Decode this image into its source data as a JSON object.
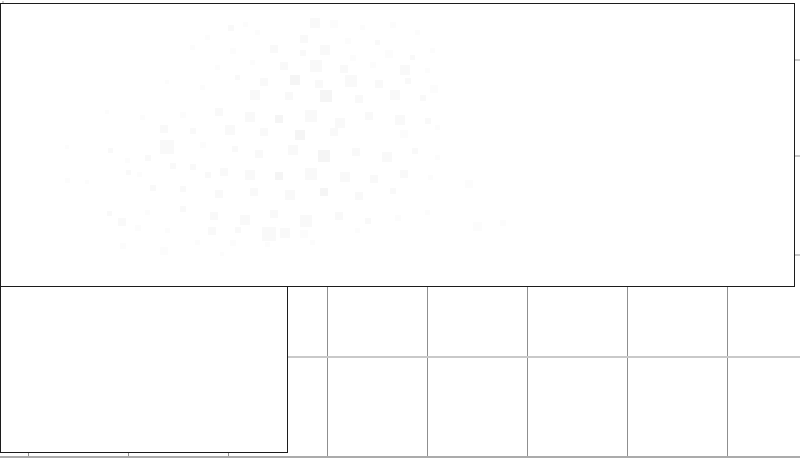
{
  "window": {
    "background_color": "#ffffff",
    "width_px": 800,
    "height_px": 458
  },
  "colors": {
    "panel_frame": "#1c1c1c",
    "panel_fill": "#ffffff",
    "grid_vertical": "#8f8f8f",
    "grid_horizontal": "#c9c9c9",
    "bottom_edge_line": "#ababab",
    "corner_tick": "#cfcfcf"
  },
  "chart_data": {
    "type": "heatmap",
    "title": "",
    "xlabel": "",
    "ylabel": "",
    "description": "Figure with two white framed axes panels over a background grid; top panel contains an extremely faint near-white blocky heatmap speckle cloud; no text labels are visible anywhere.",
    "grid": {
      "spacing_px": 100,
      "vertical_x": [
        28,
        128,
        228,
        327,
        427,
        527,
        627,
        727
      ],
      "horizontal_y": [
        59,
        155,
        254,
        356
      ],
      "bottom_edge_y": 456
    },
    "tick_marks": {
      "right_edge_y": [
        59,
        155,
        254
      ],
      "bottom_edge_x": [
        28,
        128,
        228
      ]
    },
    "point_shades": [
      "#f5f5f5",
      "#f9f9f9",
      "#fcfcfc"
    ],
    "points": [
      [
        243,
        22,
        5,
        2
      ],
      [
        228,
        25,
        6,
        1
      ],
      [
        310,
        18,
        10,
        1
      ],
      [
        330,
        20,
        8,
        2
      ],
      [
        360,
        25,
        5,
        2
      ],
      [
        390,
        22,
        6,
        2
      ],
      [
        205,
        35,
        5,
        2
      ],
      [
        255,
        30,
        5,
        2
      ],
      [
        300,
        35,
        8,
        1
      ],
      [
        345,
        38,
        6,
        2
      ],
      [
        415,
        30,
        5,
        2
      ],
      [
        375,
        40,
        5,
        1
      ],
      [
        190,
        45,
        5,
        2
      ],
      [
        230,
        48,
        6,
        2
      ],
      [
        270,
        45,
        8,
        1
      ],
      [
        300,
        50,
        6,
        1
      ],
      [
        320,
        45,
        10,
        1
      ],
      [
        350,
        55,
        6,
        2
      ],
      [
        385,
        50,
        8,
        2
      ],
      [
        410,
        55,
        5,
        1
      ],
      [
        430,
        48,
        5,
        2
      ],
      [
        250,
        60,
        5,
        2
      ],
      [
        280,
        62,
        8,
        1
      ],
      [
        310,
        60,
        12,
        1
      ],
      [
        340,
        65,
        8,
        1
      ],
      [
        370,
        62,
        6,
        2
      ],
      [
        400,
        65,
        10,
        1
      ],
      [
        425,
        68,
        5,
        2
      ],
      [
        215,
        65,
        5,
        2
      ],
      [
        235,
        75,
        5,
        1
      ],
      [
        260,
        78,
        8,
        1
      ],
      [
        290,
        75,
        10,
        0
      ],
      [
        315,
        80,
        8,
        1
      ],
      [
        345,
        75,
        12,
        1
      ],
      [
        375,
        80,
        8,
        1
      ],
      [
        405,
        78,
        6,
        1
      ],
      [
        430,
        85,
        8,
        2
      ],
      [
        200,
        85,
        5,
        2
      ],
      [
        250,
        90,
        10,
        1
      ],
      [
        285,
        92,
        8,
        1
      ],
      [
        320,
        90,
        12,
        0
      ],
      [
        355,
        95,
        8,
        1
      ],
      [
        390,
        90,
        10,
        1
      ],
      [
        420,
        95,
        6,
        1
      ],
      [
        165,
        80,
        4,
        2
      ],
      [
        105,
        110,
        4,
        2
      ],
      [
        140,
        115,
        5,
        2
      ],
      [
        180,
        112,
        6,
        2
      ],
      [
        215,
        108,
        8,
        1
      ],
      [
        245,
        112,
        10,
        1
      ],
      [
        275,
        115,
        8,
        0
      ],
      [
        305,
        110,
        12,
        1
      ],
      [
        335,
        118,
        10,
        1
      ],
      [
        365,
        112,
        8,
        1
      ],
      [
        395,
        115,
        10,
        1
      ],
      [
        425,
        118,
        6,
        1
      ],
      [
        160,
        125,
        8,
        1
      ],
      [
        190,
        128,
        6,
        1
      ],
      [
        225,
        125,
        10,
        1
      ],
      [
        260,
        128,
        8,
        1
      ],
      [
        295,
        130,
        10,
        0
      ],
      [
        330,
        128,
        8,
        1
      ],
      [
        400,
        130,
        8,
        2
      ],
      [
        435,
        125,
        5,
        2
      ],
      [
        65,
        145,
        4,
        2
      ],
      [
        108,
        148,
        5,
        1
      ],
      [
        160,
        140,
        14,
        1
      ],
      [
        200,
        142,
        6,
        2
      ],
      [
        232,
        146,
        6,
        1
      ],
      [
        255,
        150,
        8,
        1
      ],
      [
        288,
        145,
        10,
        1
      ],
      [
        318,
        150,
        12,
        0
      ],
      [
        352,
        148,
        8,
        1
      ],
      [
        382,
        152,
        10,
        1
      ],
      [
        412,
        148,
        6,
        1
      ],
      [
        435,
        155,
        5,
        2
      ],
      [
        125,
        158,
        5,
        2
      ],
      [
        145,
        155,
        6,
        1
      ],
      [
        126,
        170,
        5,
        1
      ],
      [
        137,
        172,
        5,
        2
      ],
      [
        170,
        163,
        6,
        1
      ],
      [
        190,
        164,
        6,
        1
      ],
      [
        205,
        172,
        6,
        1
      ],
      [
        220,
        168,
        8,
        1
      ],
      [
        245,
        170,
        10,
        1
      ],
      [
        275,
        172,
        8,
        0
      ],
      [
        305,
        168,
        12,
        1
      ],
      [
        340,
        172,
        10,
        1
      ],
      [
        370,
        175,
        8,
        1
      ],
      [
        400,
        170,
        8,
        1
      ],
      [
        428,
        175,
        5,
        2
      ],
      [
        65,
        178,
        5,
        2
      ],
      [
        85,
        180,
        4,
        2
      ],
      [
        150,
        185,
        6,
        1
      ],
      [
        180,
        186,
        6,
        1
      ],
      [
        215,
        190,
        8,
        1
      ],
      [
        250,
        188,
        8,
        1
      ],
      [
        285,
        190,
        10,
        1
      ],
      [
        320,
        188,
        8,
        0
      ],
      [
        355,
        192,
        8,
        1
      ],
      [
        390,
        188,
        6,
        1
      ],
      [
        465,
        180,
        8,
        2
      ],
      [
        107,
        211,
        5,
        1
      ],
      [
        118,
        218,
        8,
        1
      ],
      [
        145,
        210,
        5,
        2
      ],
      [
        180,
        206,
        6,
        1
      ],
      [
        210,
        212,
        8,
        1
      ],
      [
        240,
        215,
        10,
        1
      ],
      [
        270,
        210,
        8,
        1
      ],
      [
        300,
        215,
        12,
        1
      ],
      [
        335,
        212,
        8,
        1
      ],
      [
        365,
        218,
        6,
        1
      ],
      [
        395,
        215,
        6,
        2
      ],
      [
        425,
        210,
        5,
        2
      ],
      [
        473,
        222,
        9,
        2
      ],
      [
        500,
        220,
        6,
        2
      ],
      [
        135,
        225,
        6,
        2
      ],
      [
        165,
        228,
        5,
        2
      ],
      [
        208,
        227,
        8,
        1
      ],
      [
        235,
        227,
        6,
        1
      ],
      [
        262,
        227,
        14,
        1
      ],
      [
        280,
        228,
        10,
        1
      ],
      [
        300,
        230,
        8,
        2
      ],
      [
        355,
        228,
        5,
        2
      ],
      [
        120,
        243,
        6,
        2
      ],
      [
        160,
        247,
        8,
        2
      ],
      [
        195,
        240,
        5,
        2
      ],
      [
        230,
        240,
        6,
        2
      ],
      [
        265,
        242,
        5,
        2
      ],
      [
        310,
        240,
        5,
        2
      ],
      [
        220,
        252,
        4,
        2
      ]
    ]
  }
}
